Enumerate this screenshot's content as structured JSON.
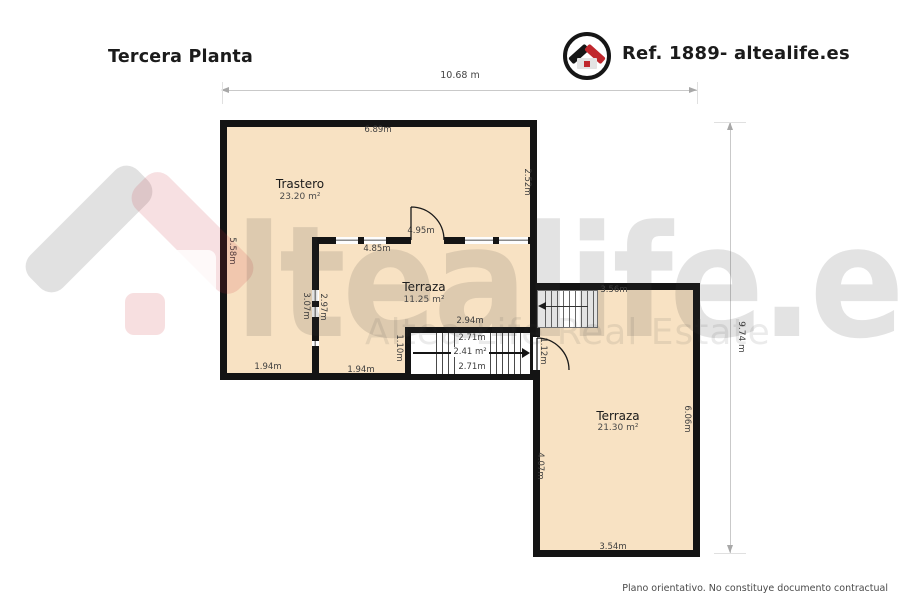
{
  "header": {
    "title": "Tercera Planta",
    "ref": "Ref. 1889- altealife.es"
  },
  "watermark": {
    "brand": "ltealife.es",
    "subtitle": "Altea Life Real Estate"
  },
  "plan": {
    "overall_width": "10.68 m",
    "overall_height": "9.74 m",
    "rooms": [
      {
        "name": "Trastero",
        "area": "23.20 m²"
      },
      {
        "name": "Terraza",
        "area": "11.25 m²"
      },
      {
        "name": "Terraza",
        "area": "21.30 m²"
      }
    ],
    "dims": {
      "trastero_top": "6.89m",
      "trastero_right": "2.52m",
      "trastero_left": "5.58m",
      "door_opening": "4.95m",
      "terraza_mid_top": "4.85m",
      "left_col_height": "3.07m",
      "terraza_mid_left": "2.97m",
      "stair_width": "2.94m",
      "stair_flight_top": "2.71m",
      "stair_mid": "2.41 m²",
      "stair_flight_bottom": "2.71m",
      "stair_left": "1.10m",
      "door2_opening": "1.12m",
      "left_col_bottom": "1.94m",
      "terraza_mid_bottom": "1.94m",
      "stair2_width": "3.56m",
      "terraza_right_right": "6.06m",
      "terraza_right_left": "4.07m",
      "terraza_right_bottom": "3.54m"
    }
  },
  "footer": {
    "disclaimer": "Plano orientativo. No constituye documento contractual"
  },
  "colors": {
    "accent_red": "#C0272D",
    "wall": "#141414",
    "floor": "#F8E2C3"
  }
}
